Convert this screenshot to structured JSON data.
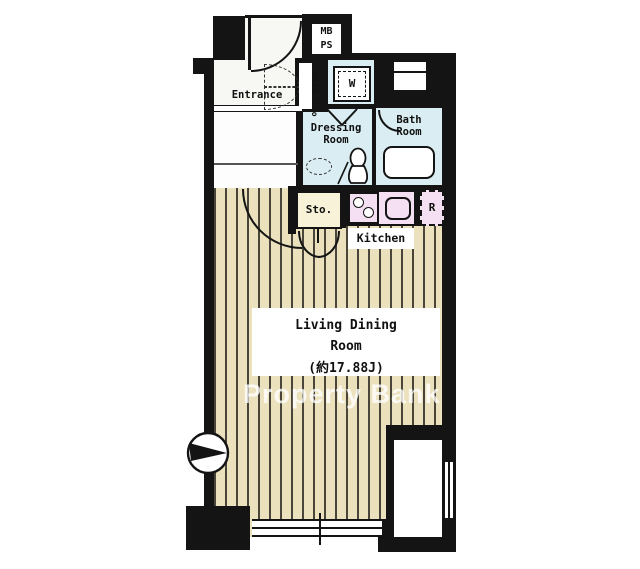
{
  "floorplan": {
    "rooms": {
      "entrance": {
        "label": "Entrance"
      },
      "shoe_closet": {
        "label": "Shoe Clo"
      },
      "meter_box": {
        "line1": "MB",
        "line2": "PS"
      },
      "washer": {
        "label": "W"
      },
      "dressing_room": {
        "line1": "Dressing",
        "line2": "Room"
      },
      "bath_room": {
        "line1": "Bath",
        "line2": "Room"
      },
      "storage": {
        "label": "Sto."
      },
      "kitchen": {
        "label": "Kitchen"
      },
      "refrigerator": {
        "label": "R"
      },
      "living_dining": {
        "line1": "Living Dining",
        "line2": "Room",
        "line3": "(約17.88J)"
      }
    },
    "watermark": "Property Bank",
    "compass_icon": "north-arrow-pointing-right",
    "colors": {
      "wall": "#141414",
      "wet_area": "#daedf2",
      "wood_floor": "#ece1bd",
      "wood_stripe": "#49453a",
      "kitchen_counter": "#f5dff2",
      "storage_fill": "#f8f3d8"
    }
  }
}
